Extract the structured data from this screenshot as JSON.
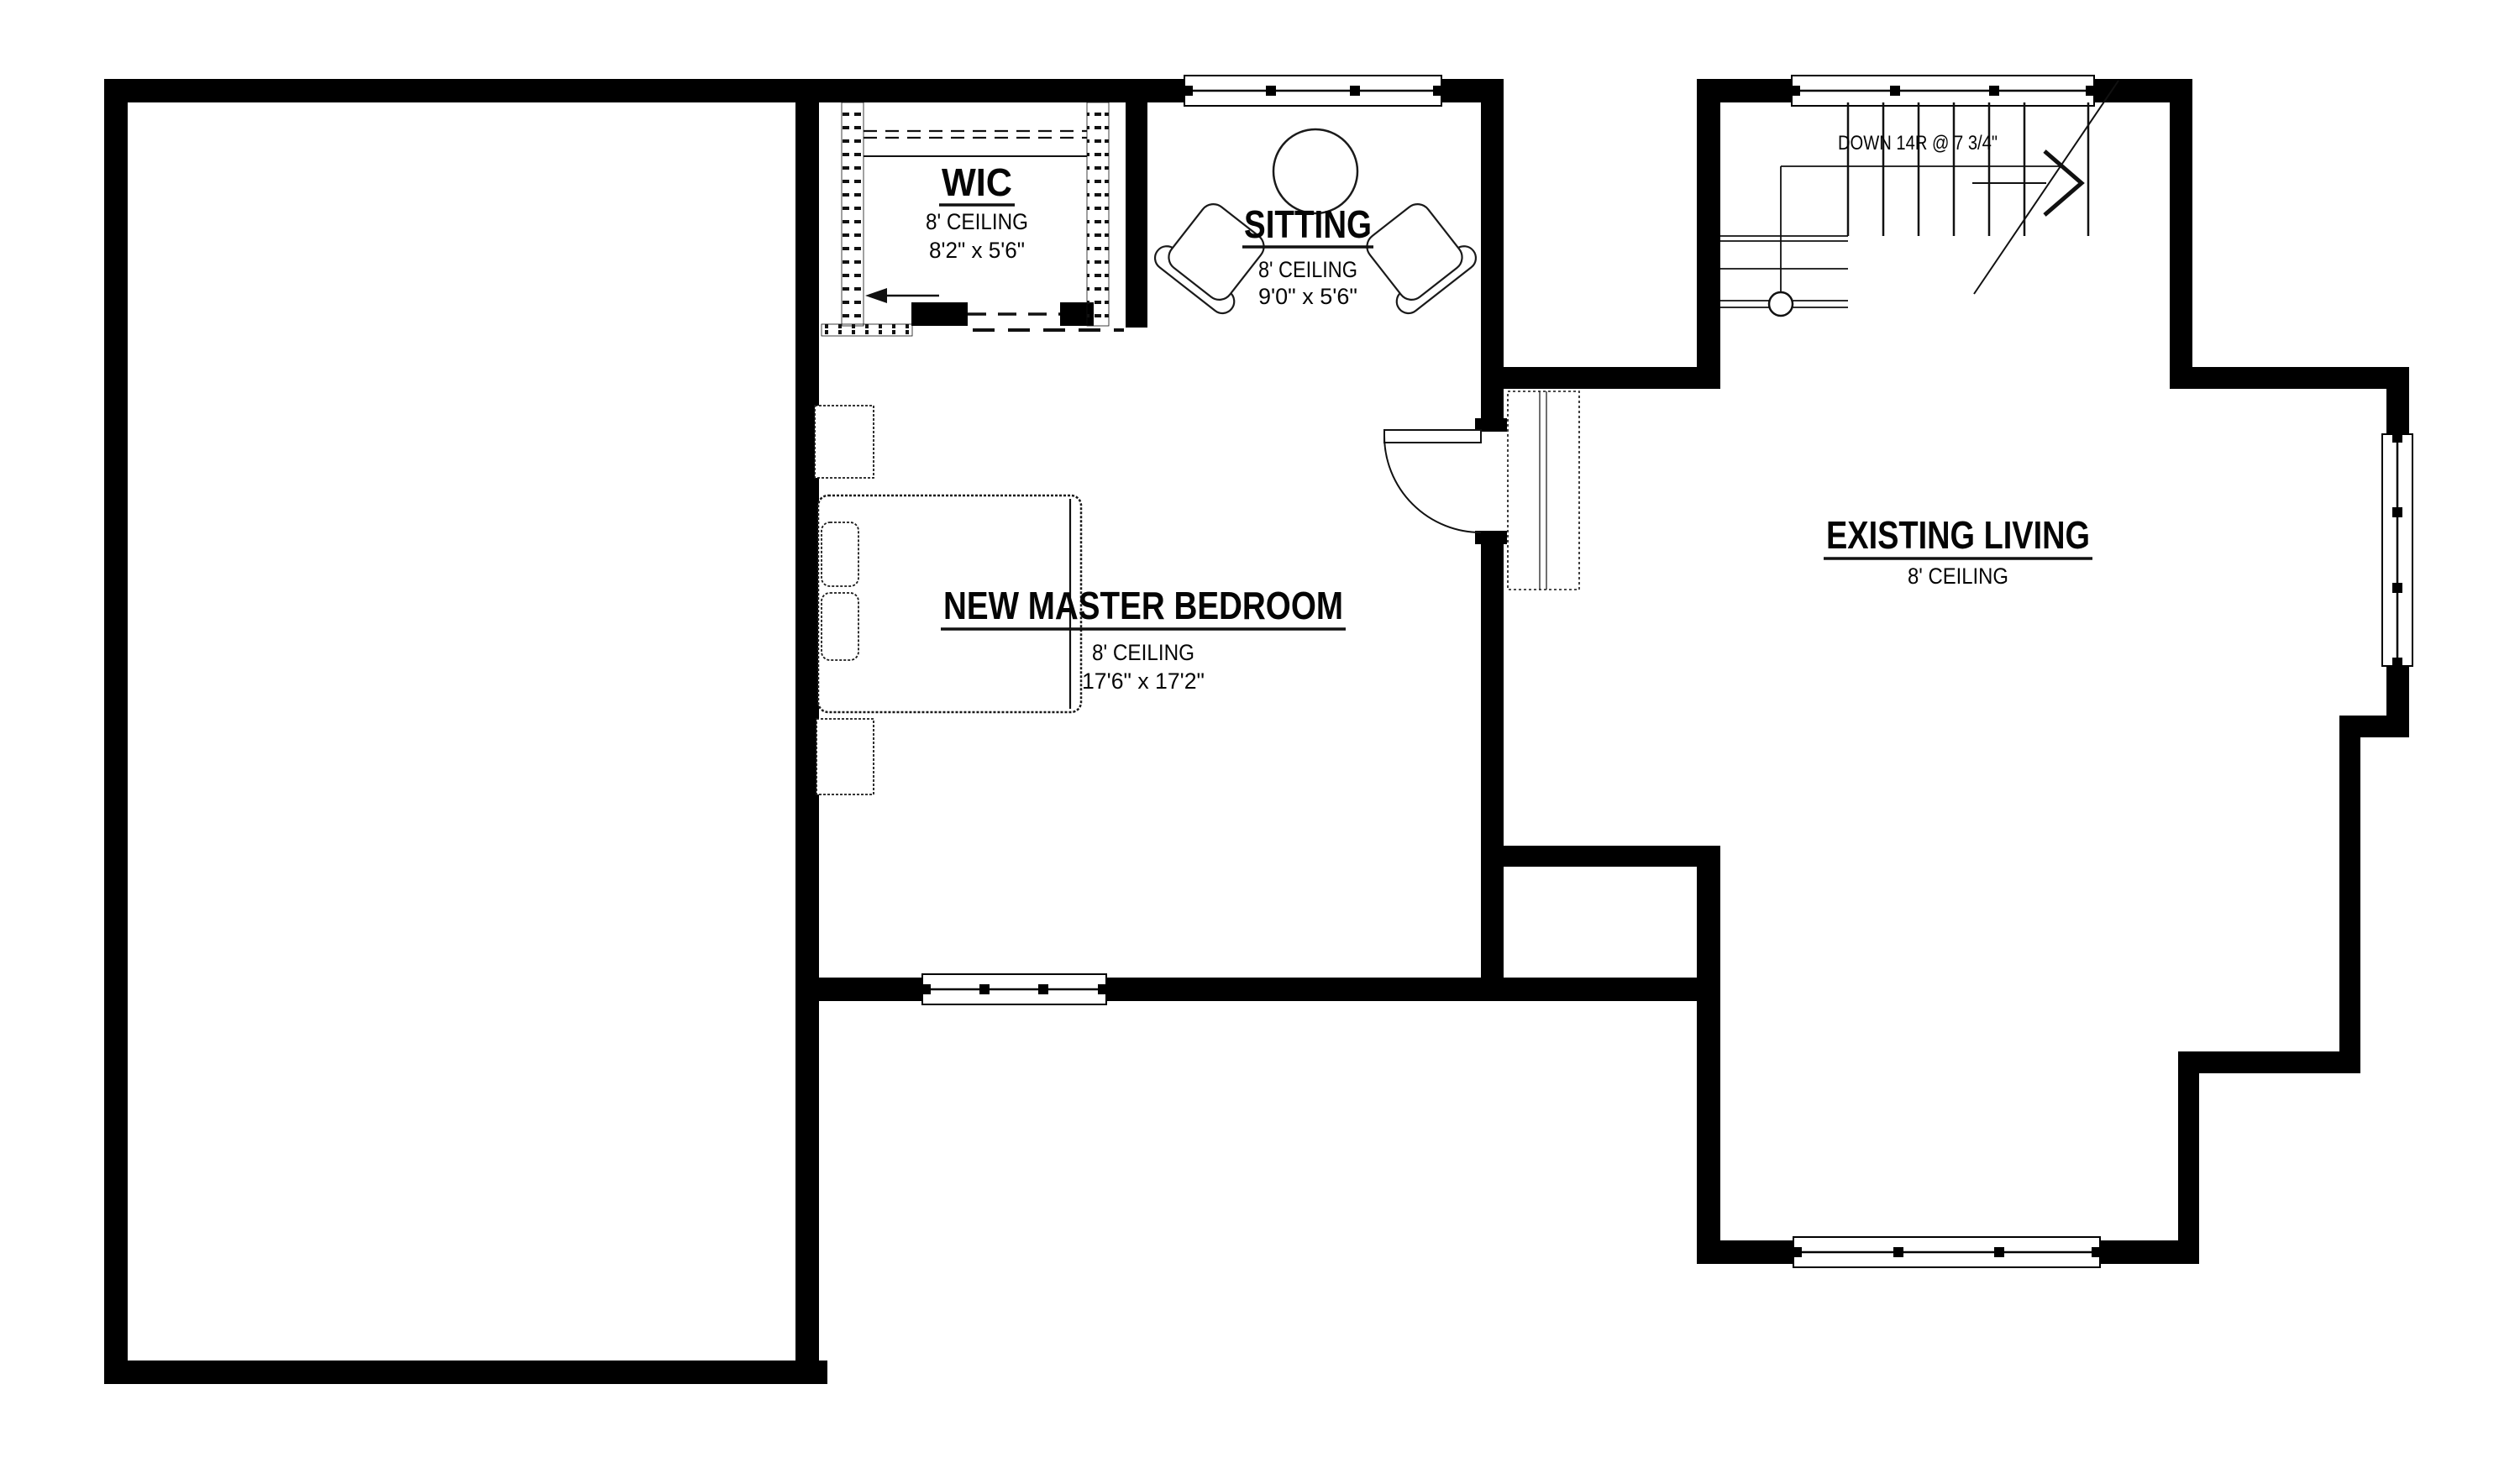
{
  "rooms": {
    "wic": {
      "name": "WIC",
      "ceiling": "8' CEILING",
      "dims": "8'2\" x 5'6\""
    },
    "sitting": {
      "name": "SITTING",
      "ceiling": "8' CEILING",
      "dims": "9'0\" x 5'6\""
    },
    "master_bedroom": {
      "name": "NEW MASTER BEDROOM",
      "ceiling": "8' CEILING",
      "dims": "17'6\" x 17'2\""
    },
    "existing_living": {
      "name": "EXISTING LIVING",
      "ceiling": "8' CEILING"
    }
  },
  "stairs": {
    "label": "DOWN 14R @ 7 3/4\""
  },
  "colors": {
    "walls": "#000000",
    "background": "#ffffff",
    "linework": "#111111"
  }
}
